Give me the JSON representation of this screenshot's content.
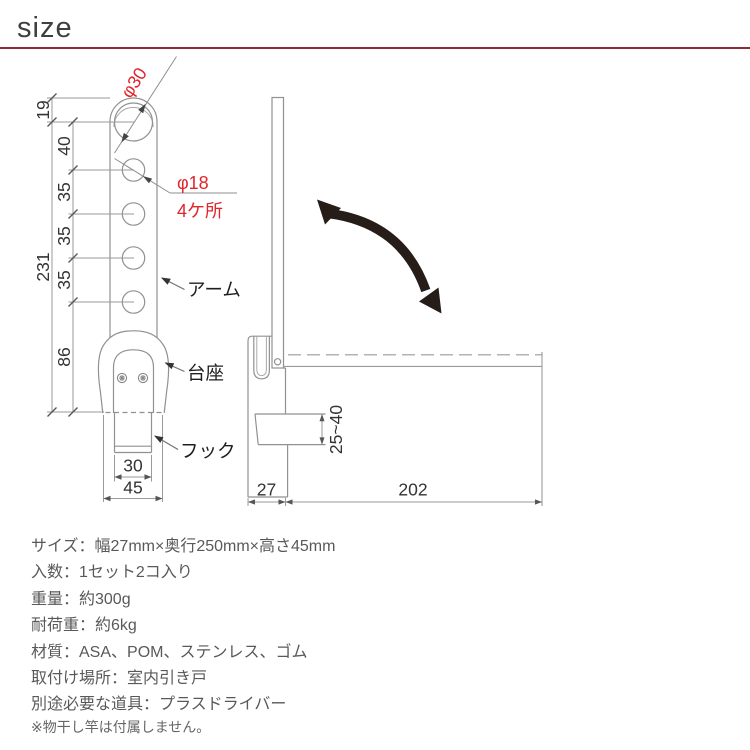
{
  "header": {
    "title": "size"
  },
  "front_view": {
    "callouts": {
      "phi30": "φ30",
      "phi18": "φ18",
      "phi18_count": "4ケ所"
    },
    "labels": {
      "arm": "アーム",
      "base": "台座",
      "hook": "フック"
    },
    "dims": {
      "d19": "19",
      "d40": "40",
      "d35a": "35",
      "d35b": "35",
      "d35c": "35",
      "d231": "231",
      "d86": "86",
      "d30": "30",
      "d45": "45"
    }
  },
  "side_view": {
    "dims": {
      "d27": "27",
      "d202": "202",
      "range": "25~40"
    }
  },
  "specs": {
    "lines": [
      "サイズ：幅27mm×奥行250mm×高さ45mm",
      "入数：1セット2コ入り",
      "重量：約300g",
      "耐荷重：約6kg",
      "材質：ASA、POM、ステンレス、ゴム",
      "取付け場所：室内引き戸",
      "別途必要な道具：プラスドライバー"
    ]
  },
  "note": "※物干し竿は付属しません。",
  "colors": {
    "accent_red": "#e0252c",
    "rule_red": "#8e2b3a",
    "line_gray": "#919191",
    "dim_text": "#333333",
    "spec_text": "#595959",
    "rotation_arrow": "#261d19"
  }
}
